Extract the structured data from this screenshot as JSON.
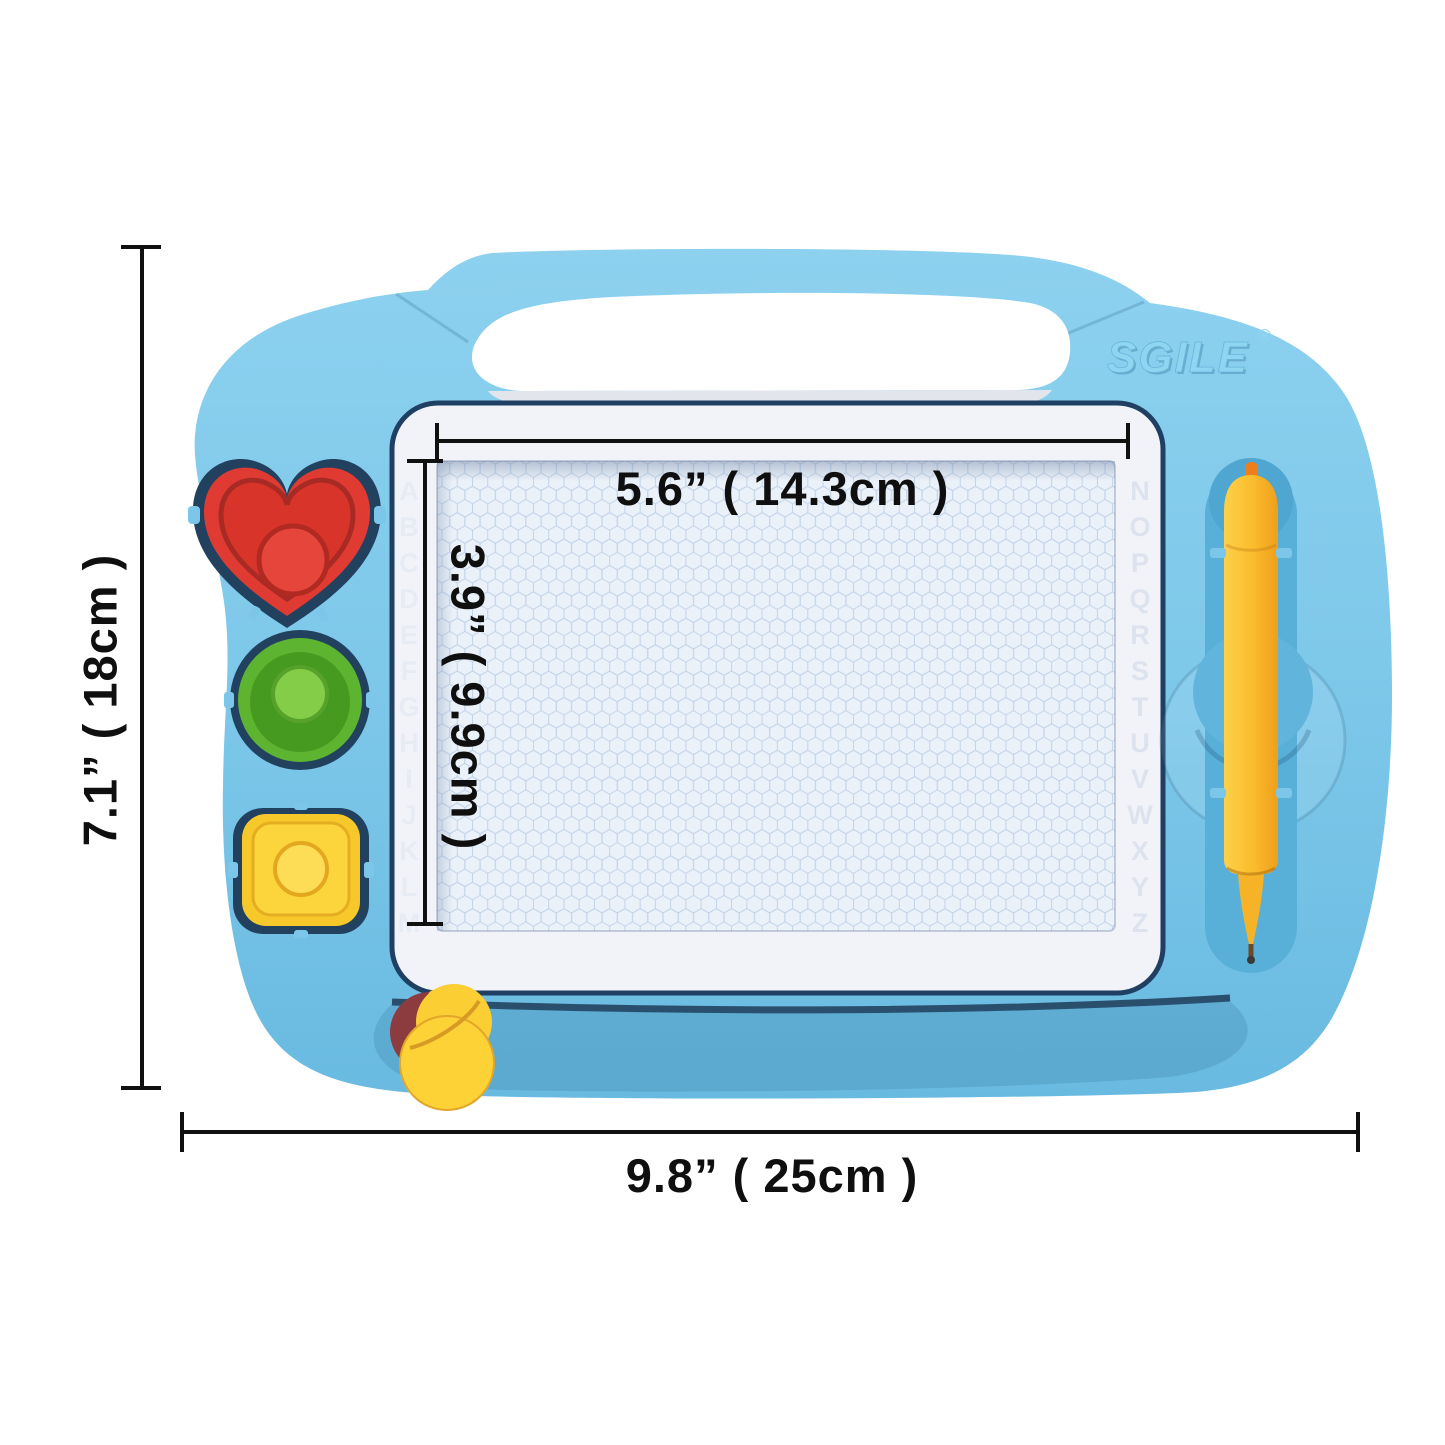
{
  "board": {
    "brand": "SGILE",
    "brand_reg": "®",
    "alphabet_left": "ABCDEFGHIJKLM",
    "alphabet_right": "NOPQRSTUVWXYZ"
  },
  "dimensions": {
    "screen_width_label": "5.6” ( 14.3cm )",
    "screen_height_label": "3.9” ( 9.9cm )",
    "board_height_label": "7.1” ( 18cm )",
    "board_width_label": "9.8” ( 25cm )"
  },
  "colors": {
    "body_blue": "#7cc7e9",
    "recess_blue": "#58afd8",
    "frame_white": "#f1f3f8",
    "frame_border_navy": "#1f3f63",
    "screen_bg": "#ebf1f9",
    "honeycomb_line": "#c2d3e9",
    "stamp_red": "#e03b32",
    "stamp_green": "#56b22e",
    "stamp_yellow": "#f7c829",
    "pen_yellow": "#fbbe2e",
    "pen_nub_orange": "#ee7d1b",
    "slider_yellow": "#fcd237",
    "dimension_line": "#101010"
  }
}
